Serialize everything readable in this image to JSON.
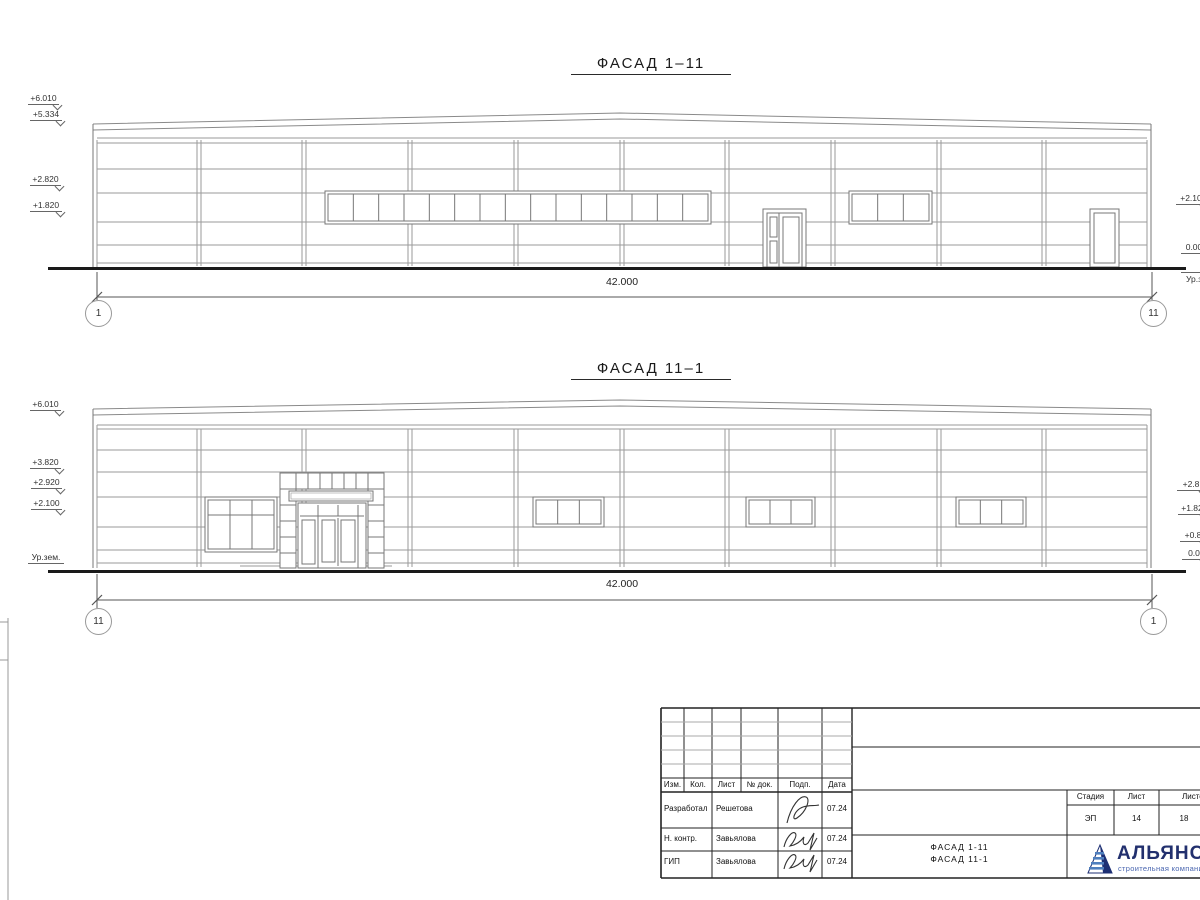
{
  "facade1": {
    "title": "ФАСАД 1–11",
    "dim": "42.000",
    "axis_left": "1",
    "axis_right": "11",
    "levels_left": [
      "+6.010",
      "+5.334",
      "+2.820",
      "+1.820"
    ],
    "levels_right": [
      "+2.10",
      "0.00",
      "Ур.з"
    ]
  },
  "facade2": {
    "title": "ФАСАД 11–1",
    "dim": "42.000",
    "axis_left": "11",
    "axis_right": "1",
    "levels_left": [
      "+6.010",
      "+3.820",
      "+2.920",
      "+2.100",
      "Ур.зем."
    ],
    "levels_right": [
      "+2.8",
      "+1.82",
      "+0.8",
      "0.0"
    ]
  },
  "titleblock": {
    "columns": [
      "Изм.",
      "Кол.",
      "Лист",
      "№ док.",
      "Подп.",
      "Дата"
    ],
    "rows": [
      {
        "role": "Разработал",
        "name": "Решетова",
        "date": "07.24"
      },
      {
        "role": "Н. контр.",
        "name": "Завьялова",
        "date": "07.24"
      },
      {
        "role": "ГИП",
        "name": "Завьялова",
        "date": "07.24"
      }
    ],
    "doc_title_line1": "ФАСАД 1-11",
    "doc_title_line2": "ФАСАД 11-1",
    "stage_header": "Стадия",
    "sheet_header": "Лист",
    "sheets_header": "Листов",
    "stage": "ЭП",
    "sheet": "14",
    "sheets": "18",
    "company": "АЛЬЯНС",
    "company_tagline": "строительная компания"
  }
}
